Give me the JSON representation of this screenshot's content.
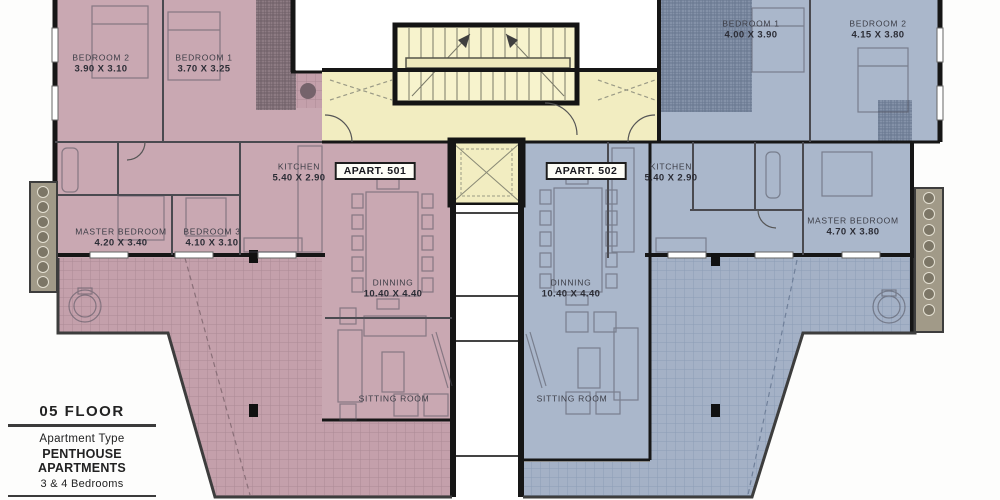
{
  "legend": {
    "floor": "05 FLOOR",
    "apartment_type_label": "Apartment Type",
    "apartment_type_value": "PENTHOUSE APARTMENTS",
    "bedrooms": "3 & 4 Bedrooms"
  },
  "colors": {
    "apartment_501": "#c9a8b2",
    "apartment_502": "#aab7cb",
    "common_core": "#f2edc1",
    "walls": "#161616"
  },
  "apartments": [
    {
      "label": "APART. 501",
      "rooms": [
        {
          "name": "BEDROOM 2",
          "dims": "3.90 X 3.10"
        },
        {
          "name": "BEDROOM 1",
          "dims": "3.70 X 3.25"
        },
        {
          "name": "KITCHEN",
          "dims": "5.40 X 2.90"
        },
        {
          "name": "MASTER BEDROOM",
          "dims": "4.20 X 3.40"
        },
        {
          "name": "BEDROOM 3",
          "dims": "4.10 X 3.10"
        },
        {
          "name": "DINNING",
          "dims": "10.40 X 4.40"
        },
        {
          "name": "SITTING ROOM",
          "dims": ""
        }
      ]
    },
    {
      "label": "APART. 502",
      "rooms": [
        {
          "name": "BEDROOM 1",
          "dims": "4.00 X 3.90"
        },
        {
          "name": "BEDROOM 2",
          "dims": "4.15 X 3.80"
        },
        {
          "name": "KITCHEN",
          "dims": "5.40 X 2.90"
        },
        {
          "name": "MASTER BEDROOM",
          "dims": "4.70 X 3.80"
        },
        {
          "name": "DINNING",
          "dims": "10.40 X 4.40"
        },
        {
          "name": "SITTING ROOM",
          "dims": ""
        }
      ]
    }
  ]
}
